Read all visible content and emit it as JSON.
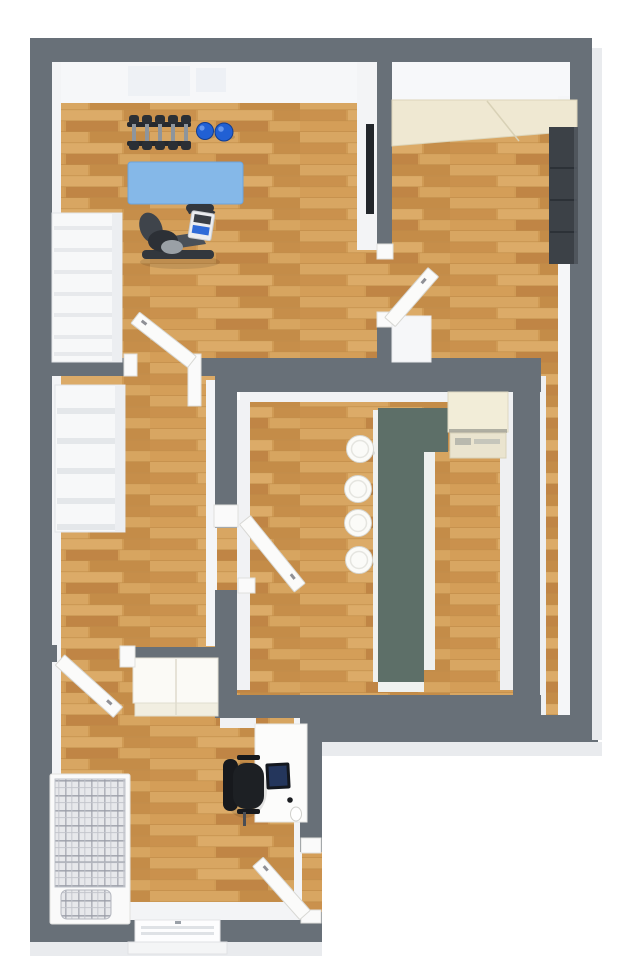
{
  "scene": {
    "type": "3d-floor-plan-top-down-view",
    "background": "#ffffff",
    "canvas_width": 623,
    "canvas_height": 960
  },
  "colors": {
    "wall": "#687078",
    "wall_inner_face": "#f3f4f6",
    "wall_outer_face": "#e9ebee",
    "floor_wood_base": "#d09b55",
    "floor_wood_dark": "#c08545",
    "floor_wood_light": "#dcab68",
    "stairs": "#f7f8f9",
    "stair_tread": "#e7e9ec",
    "door": "#fbfbfa",
    "exercise_mat": "#85b8e8",
    "medicine_ball": "#2160d4",
    "gym_equipment": "#33373d",
    "wall_tv": "#22262b",
    "closet_top": "#efe8d2",
    "tall_cabinet": "#3c4147",
    "kitchen_counter": "#5d6f68",
    "kitchen_appliance": "#f2edd8",
    "bar_stool": "#fbfbf8",
    "wardrobe": "#fbfaf6",
    "bed_frame": "#fafafa",
    "bed_plaid_base": "#e7e8eb",
    "bed_plaid_line": "#9b9ea8",
    "desk": "#fcfcfb",
    "office_chair": "#1d2024",
    "monitor": "#14181f"
  },
  "rooms": [
    {
      "id": "gym-room",
      "position": "top-left",
      "furniture": [
        "dumbbell-rack",
        "medicine-balls",
        "exercise-mat",
        "exercise-bike",
        "wall-tv"
      ]
    },
    {
      "id": "top-right-room",
      "position": "top-right",
      "furniture": [
        "closet",
        "tall-cabinet"
      ]
    },
    {
      "id": "kitchen",
      "position": "center-right",
      "furniture": [
        "island-counter",
        "appliance",
        "bar-stools"
      ]
    },
    {
      "id": "hallway",
      "position": "center-left",
      "furniture": [
        "upper-staircase",
        "lower-staircase"
      ]
    },
    {
      "id": "corridor",
      "position": "right-side",
      "furniture": []
    },
    {
      "id": "bedroom",
      "position": "bottom-left",
      "furniture": [
        "bed",
        "wardrobe",
        "desk",
        "office-chair",
        "monitor",
        "waste-bin",
        "window"
      ]
    }
  ],
  "counts": {
    "dumbbells": 5,
    "medicine_balls": 2,
    "bar_stools": 4,
    "stair_flights": 2,
    "interior_doors": 5,
    "windows": 1
  }
}
